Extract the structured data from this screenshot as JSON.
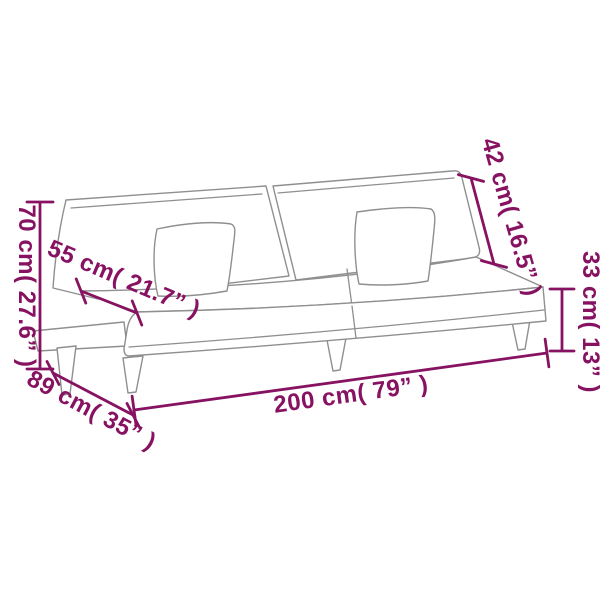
{
  "image": {
    "description": "Sofa bed line-art dimension diagram on white background",
    "background_color": "#ffffff"
  },
  "style": {
    "dimension_color": "#871261",
    "artwork_line_color": "#8f8f8f"
  },
  "dimensions": {
    "height": {
      "label": "70 cm( 27.6” )",
      "cm": 70,
      "inch": 27.6
    },
    "seat_depth": {
      "label": "55 cm( 21.7” )",
      "cm": 55,
      "inch": 21.7
    },
    "backrest_height": {
      "label": "42 cm( 16.5” )",
      "cm": 42,
      "inch": 16.5
    },
    "seat_height": {
      "label": "33 cm( 13” )",
      "cm": 33,
      "inch": 13
    },
    "length": {
      "label": "200 cm( 79” )",
      "cm": 200,
      "inch": 79
    },
    "depth": {
      "label": "89 cm( 35” )",
      "cm": 89,
      "inch": 35
    }
  }
}
